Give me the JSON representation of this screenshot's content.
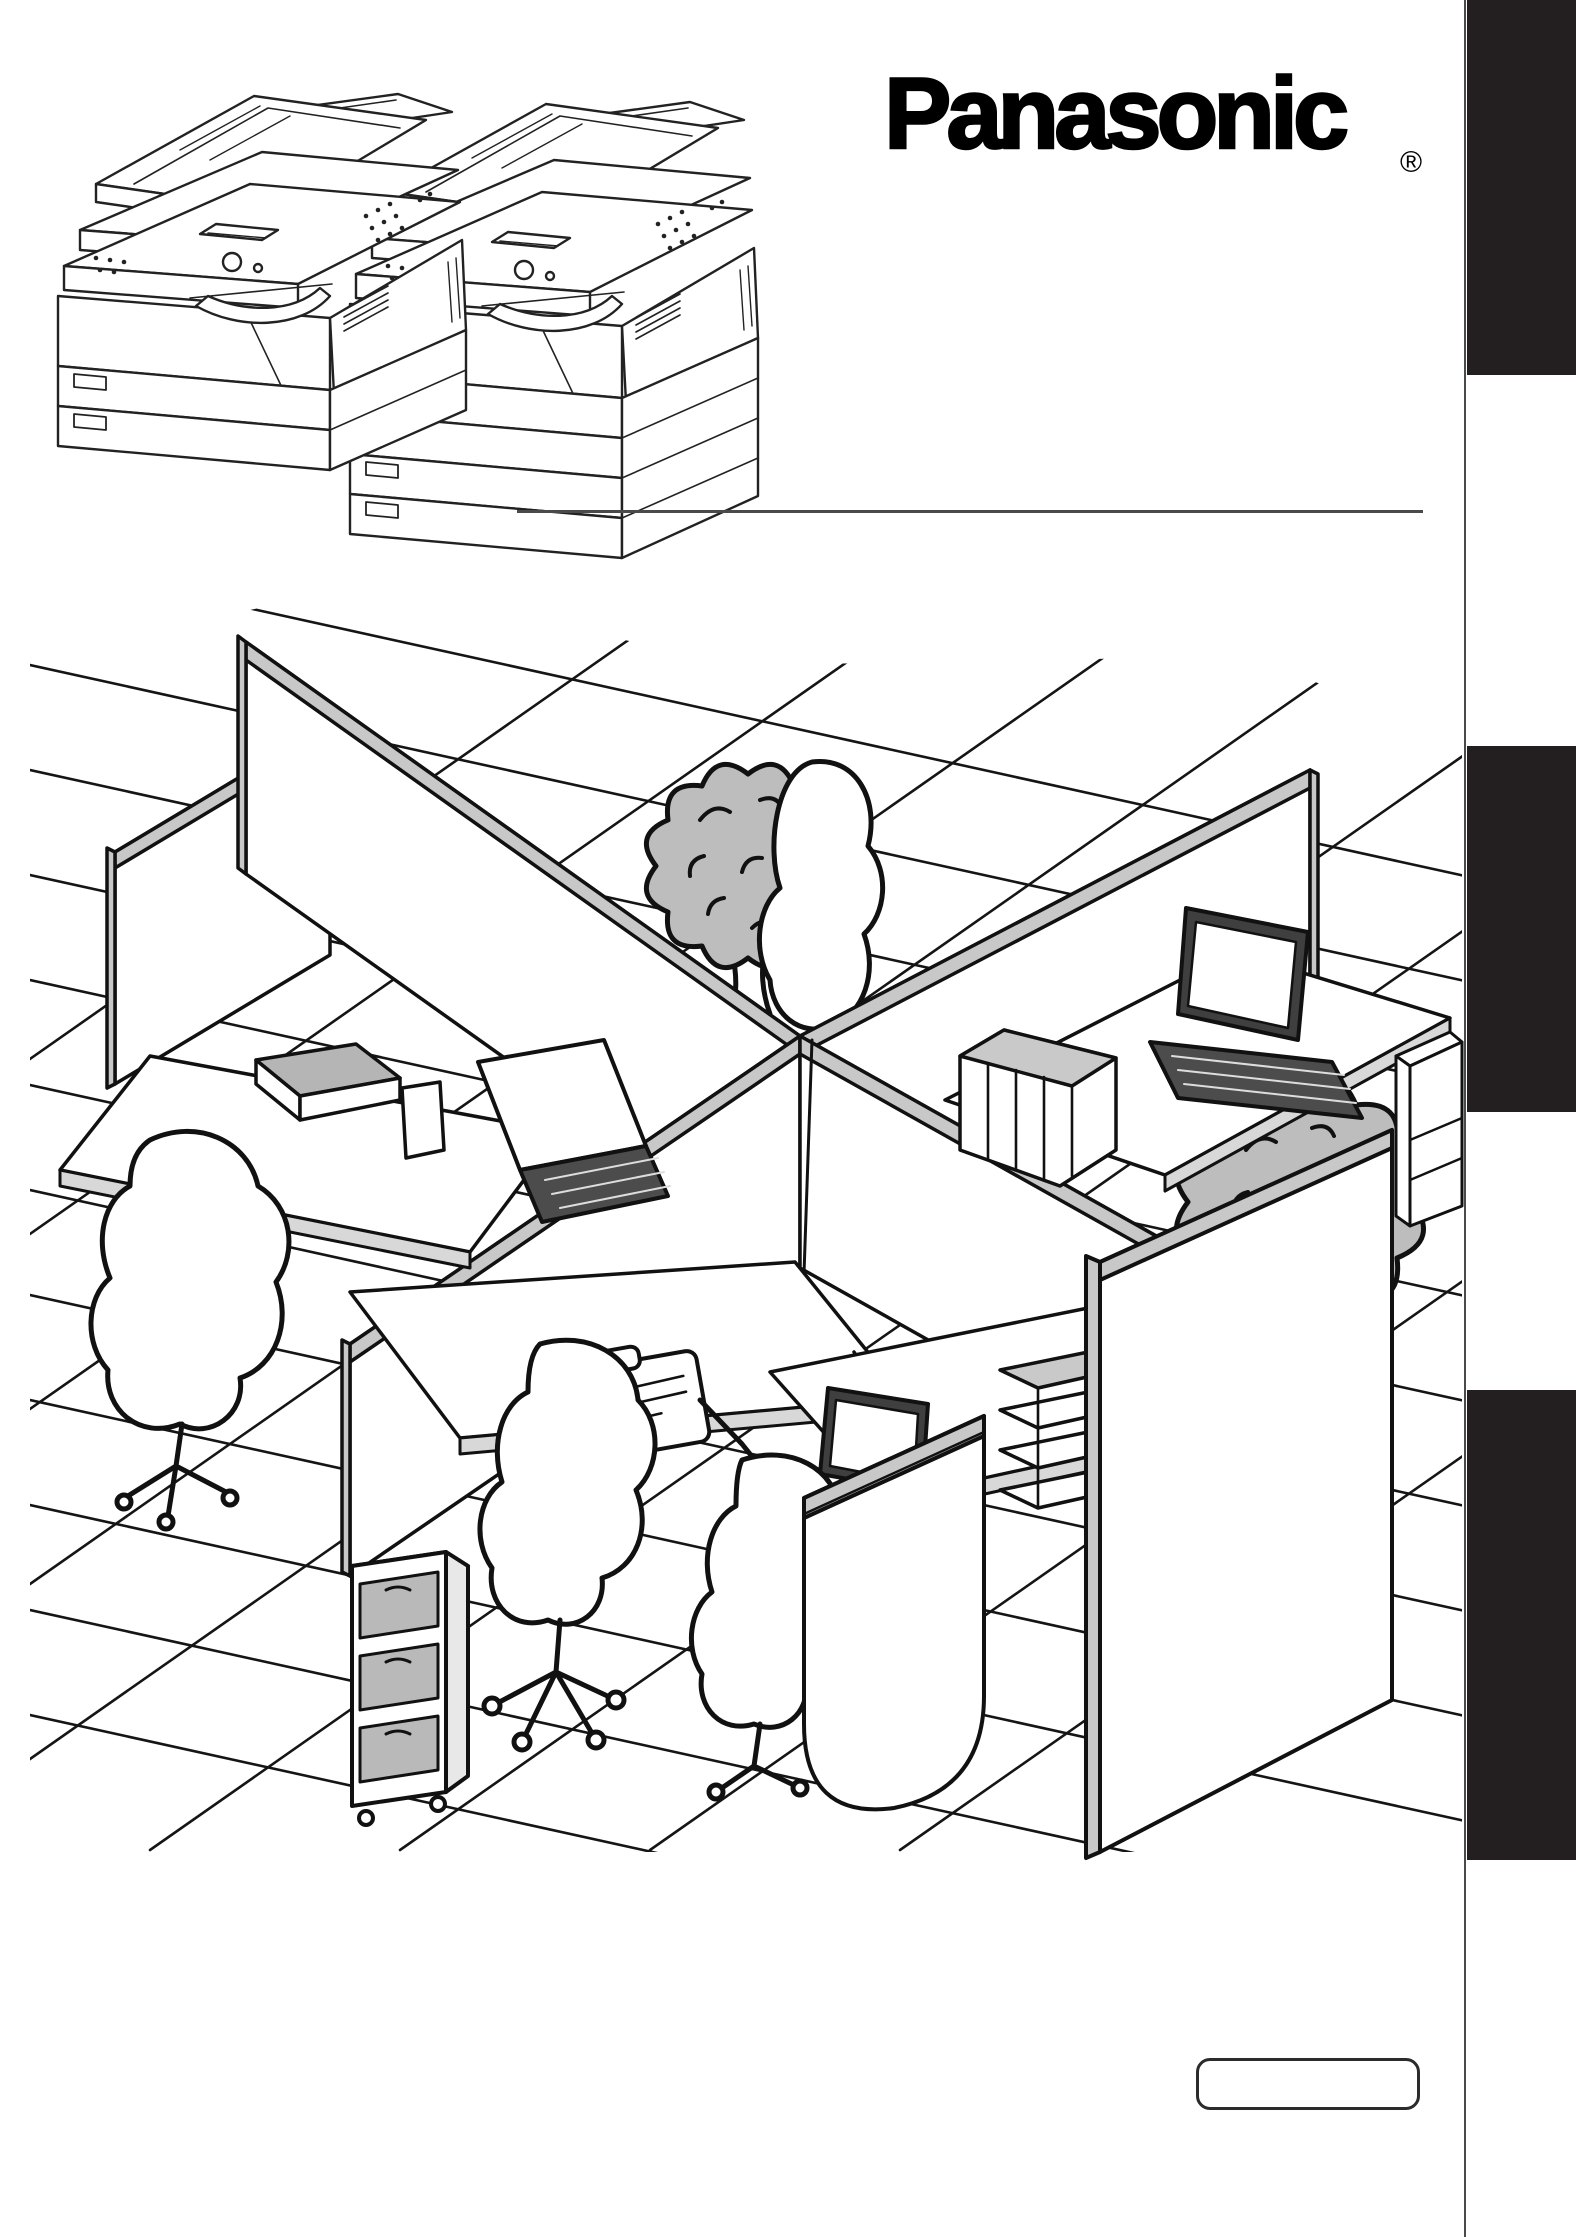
{
  "header": {
    "brand": "Panasonic",
    "registered_mark": "®"
  },
  "palette": {
    "ink": "#1a1a1a",
    "tab_black": "#231f20",
    "fill_gray": "#bdbdbd",
    "rail_gray": "#c8c8c8",
    "paper_white": "#ffffff"
  },
  "artwork": {
    "copiers": {
      "left_icon": "copier-two-tray-icon",
      "right_icon": "copier-four-tray-icon"
    },
    "office_scene": {
      "icon": "office-cubicles-illustration",
      "elements": [
        "tile-floor",
        "partition-walls",
        "office-chair",
        "desk",
        "laptop",
        "book-stack",
        "drawer-cart",
        "clipboard",
        "papers",
        "hanging-pen-cup",
        "potted-tree",
        "printer"
      ]
    }
  },
  "footer": {
    "model_box_text": ""
  }
}
